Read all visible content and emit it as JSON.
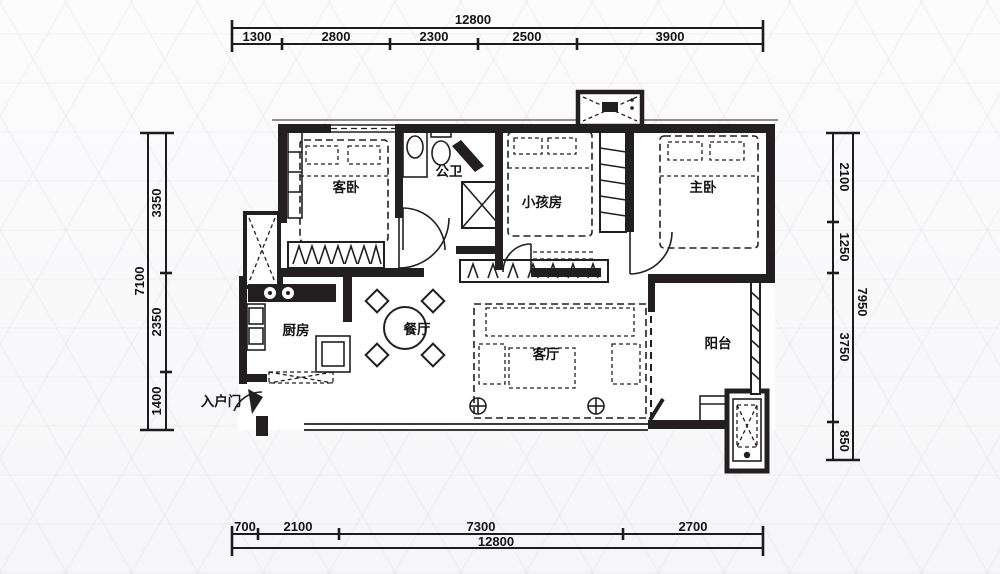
{
  "plan": {
    "rooms": [
      {
        "id": "guest-bedroom",
        "label": "客卧"
      },
      {
        "id": "bathroom",
        "label": "公卫"
      },
      {
        "id": "kids-room",
        "label": "小孩房"
      },
      {
        "id": "master-bedroom",
        "label": "主卧"
      },
      {
        "id": "kitchen",
        "label": "厨房"
      },
      {
        "id": "dining-room",
        "label": "餐厅"
      },
      {
        "id": "living-room",
        "label": "客厅"
      },
      {
        "id": "balcony",
        "label": "阳台"
      }
    ],
    "entrance_label": "入户门"
  },
  "dimensions": {
    "top": {
      "total": "12800",
      "segments": [
        "1300",
        "2800",
        "2300",
        "2500",
        "3900"
      ]
    },
    "bottom": {
      "total": "12800",
      "segments": [
        "700",
        "2100",
        "7300",
        "2700"
      ]
    },
    "left": {
      "total": "7100",
      "segments": [
        "3350",
        "2350",
        "1400"
      ]
    },
    "right": {
      "total": "7950",
      "segments": [
        "2100",
        "1250",
        "3750",
        "850"
      ]
    }
  },
  "colors": {
    "wall": "#231f20",
    "background": "#fafafa"
  }
}
